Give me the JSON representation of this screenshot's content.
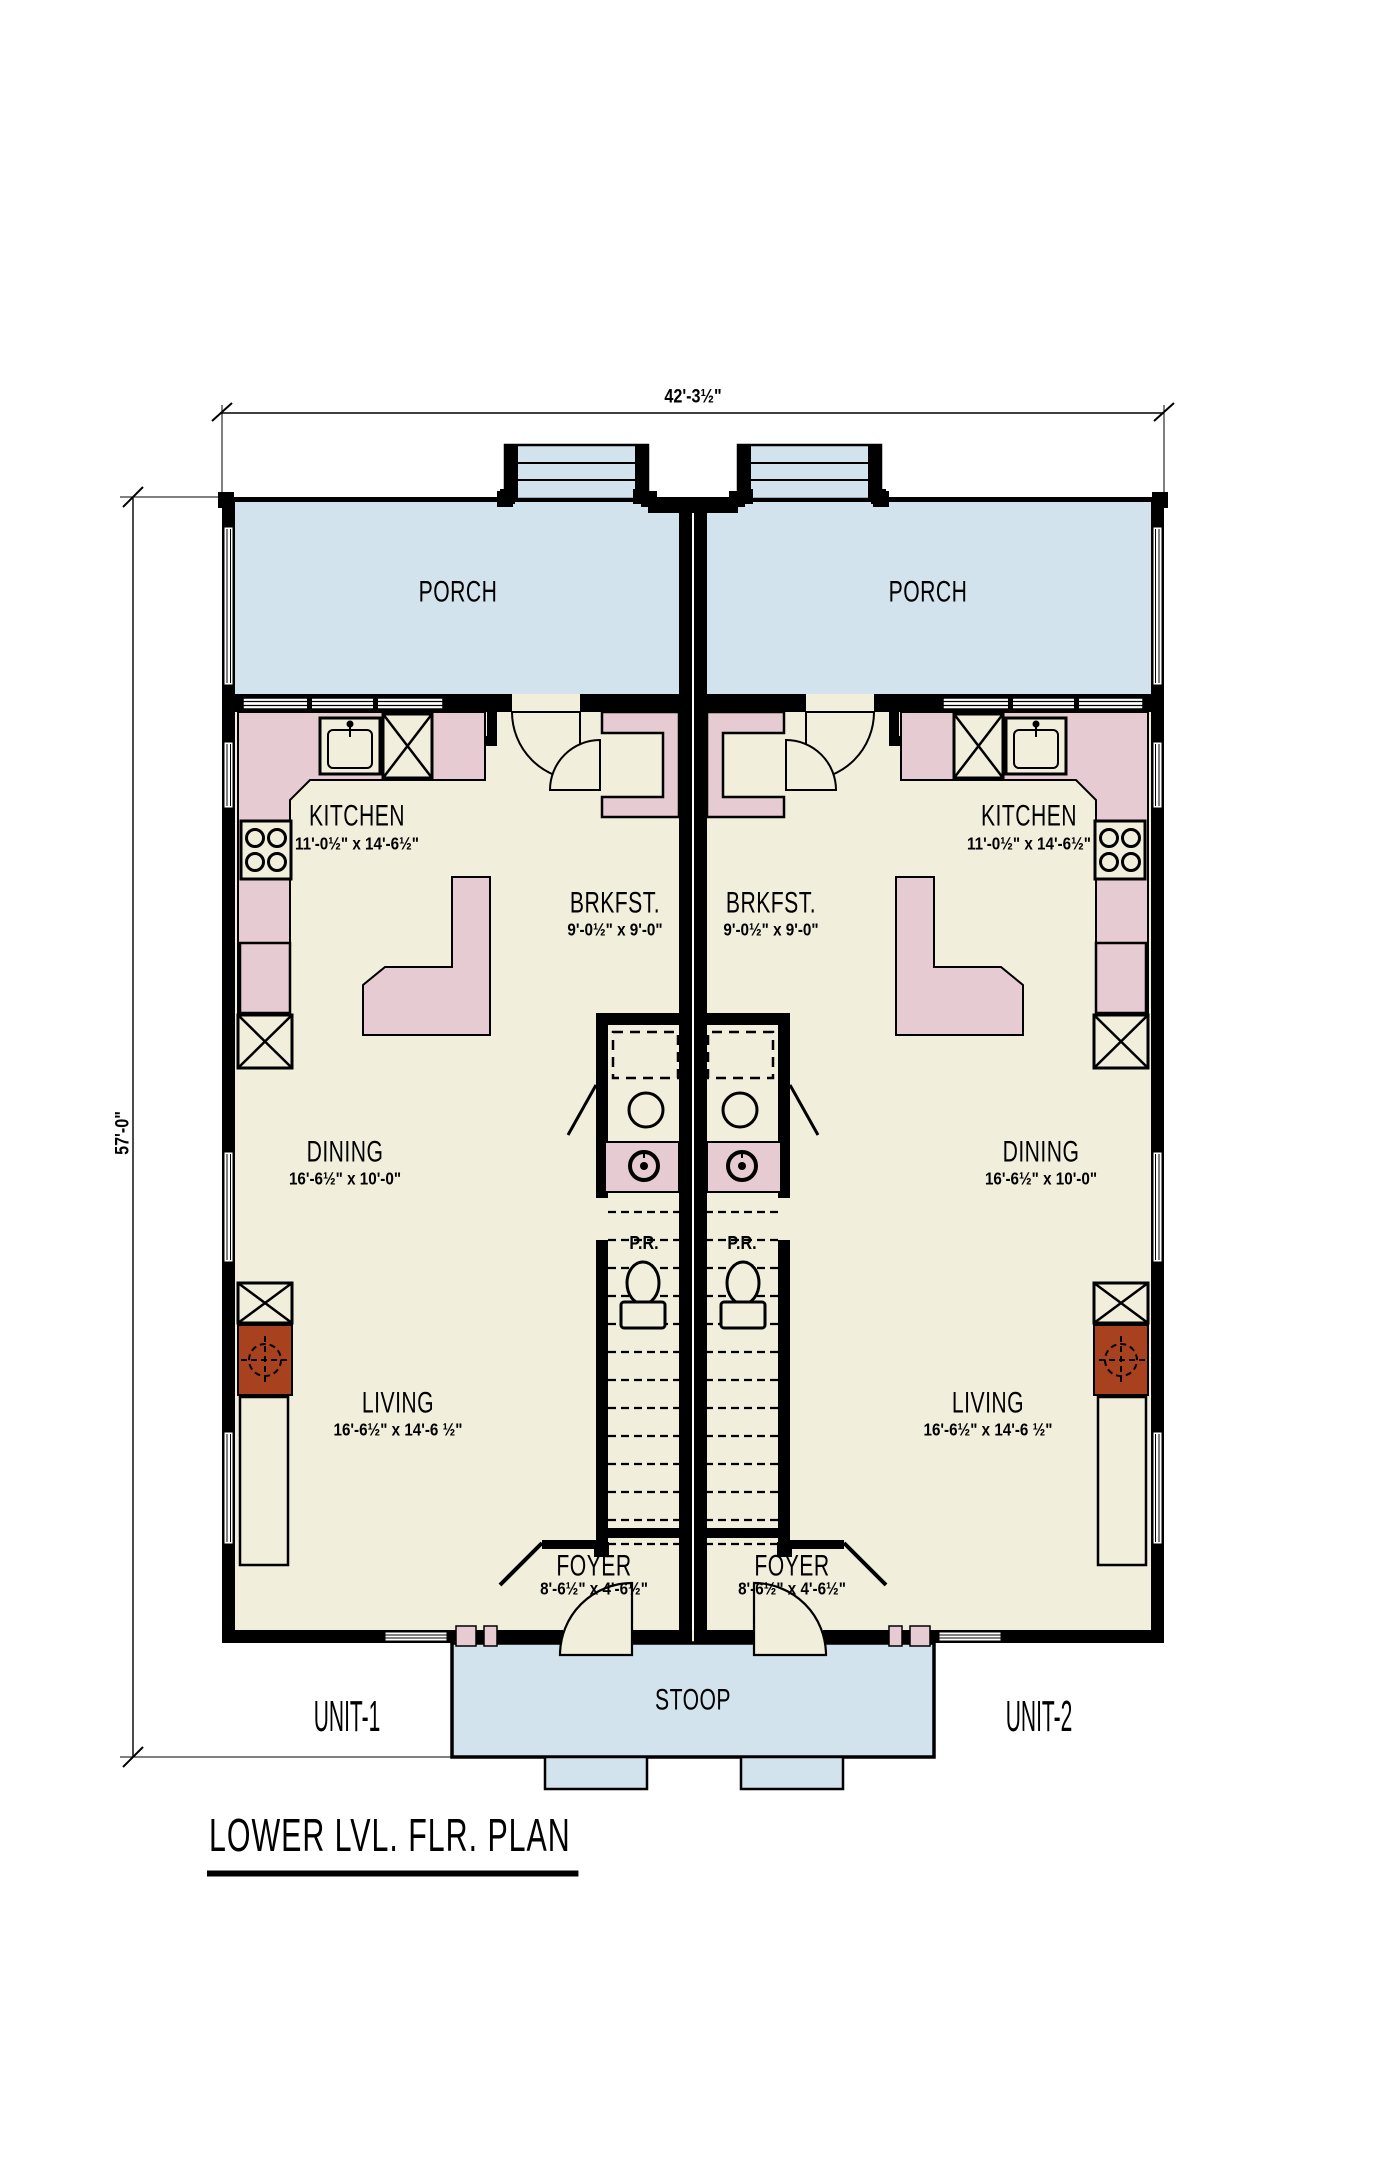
{
  "title": "LOWER LVL. FLR. PLAN",
  "overall_dims": {
    "width": "42'-3½\"",
    "depth": "57'-0\""
  },
  "unit_labels": {
    "unit1": "UNIT-1",
    "unit2": "UNIT-2"
  },
  "shared_labels": {
    "porch": "PORCH",
    "stoop": "STOOP",
    "powder_room": "P.R."
  },
  "rooms": {
    "kitchen": {
      "name": "KITCHEN",
      "size": "11'-0½\" x 14'-6½\""
    },
    "breakfast": {
      "name": "BRKFST.",
      "size": "9'-0½\" x 9'-0\""
    },
    "dining": {
      "name": "DINING",
      "size": "16'-6½\" x 10'-0\""
    },
    "living": {
      "name": "LIVING",
      "size": "16'-6½\" x 14'-6 ½\""
    },
    "foyer": {
      "name": "FOYER",
      "size": "8'-6½\" x 4'-6½\""
    }
  },
  "colors": {
    "porch": "#d3e3ee",
    "floor": "#f1eedb",
    "cabinet": "#e7cbd2",
    "fireplace": "#a8421e",
    "wall": "#000000",
    "line": "#000000"
  }
}
